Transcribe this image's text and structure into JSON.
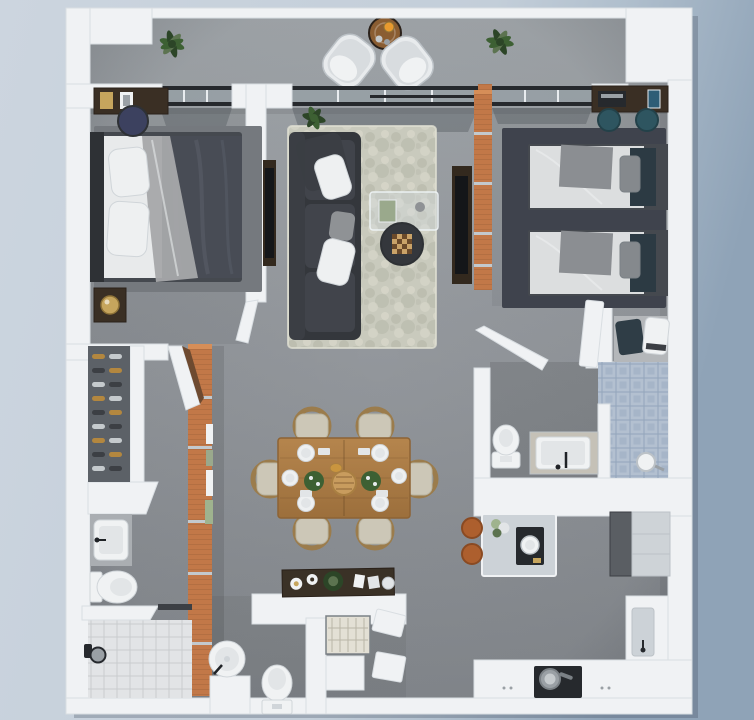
{
  "meta": {
    "scene": "3d-apartment-floor-plan-top-view",
    "canvas_width": 754,
    "canvas_height": 720
  },
  "palette": {
    "bg_left": "#ccd5df",
    "bg_mid": "#c3ced9",
    "bg_right": "#8fa3b7",
    "building_shadow": "rgba(60,72,88,0.28)",
    "wall": "#f0f2f4",
    "wall_stroke": "#d9dee2",
    "floor_light": "#a3a8ac",
    "floor": "#94989d",
    "floor_dark": "#85898e",
    "rug_living_base": "#c9cabd",
    "rug_living_blob": "#b2b4a5",
    "rug_living_light": "#dad9cc",
    "rug_bed1": "#75797e",
    "rug_bed2": "#3f434d",
    "sofa": "#34373c",
    "sofa_cushion": "#41444b",
    "sofa_edge": "#3b3e44",
    "pillow_white": "#eef0f1",
    "pillow_gray": "#8f9295",
    "mattress": "#dcdedf",
    "sheet": "#e8eaeb",
    "duvet": "#484c55",
    "duvet_fold": "#575b65",
    "drape": "#a6a8aa",
    "headboard": "#2e3135",
    "bed_frame": "#45494f",
    "throw_gray": "#8b8e92",
    "blanket_teal": "#2c3a43",
    "pillow_stripe": "#85898d",
    "wood_dark": "#3a2f24",
    "wood_dark_edge": "#2a211a",
    "wood_dining_light": "#b5854d",
    "wood_dining_deep": "#9c6f3c",
    "wood_dining_stroke": "#8d6334",
    "wood_balcony": "#8a5d32",
    "brick": "#c27848",
    "brick_cap": "#d68e58",
    "brick_band": "#c3c9cd",
    "teal_stool": "#2e5560",
    "teal_stool_dark": "#234149",
    "navy_stool": "#3c415f",
    "brass": "#c6a55d",
    "brass_dark": "#8f7338",
    "glass_rail": "#26292d",
    "glass_pane": "rgba(150,160,168,0.55)",
    "glass_mullion": "#e8ecef",
    "glass_projection": "rgba(60,66,74,0.30)",
    "tile_light_a": "#e2e4e6",
    "tile_light_b": "#c9ccce",
    "tile_blue_a": "#b3c0d0",
    "tile_blue_b": "#93a5bb",
    "counter_gray": "#aaaeb2",
    "counter_beige": "#c5c1b7",
    "fixture_white": "#f0f2f3",
    "fixture_inner": "#e2e5e7",
    "fixture_stroke": "#d0d5d9",
    "black_fixture": "#1f2226",
    "island": "#ccd2d7",
    "appliance_dark": "#26292d",
    "fridge": "#5a5e63",
    "cabinet": "#ced3d7",
    "cabinet_stroke": "#bcc2c7",
    "steel": "#9aa0a5",
    "steel_dark": "#7b8186",
    "orange_stool": "#ad5f2e",
    "orange_stool_dark": "#8a4a22",
    "orange_juice": "#e89a2f",
    "plant": "#3d6033",
    "plant_dark": "#2c4527",
    "plant_light": "#5c7350",
    "plant_pale": "#9fb38e",
    "chair_shell": "#e8ebed",
    "chair_inner": "#d8dcdf",
    "dining_cushion": "#ccc7b7",
    "dining_cushion_stroke": "#b9b4a2",
    "chair_wood": "#9b7c4c",
    "tv_screen": "#141619",
    "console_wood": "#33291e",
    "decor_tray": "#3a3126",
    "washer_top": "#e3e0d5",
    "washer_line": "#b9b6a8",
    "book_blue": "#2e5d76",
    "book_green": "#9aa98c",
    "bottle_amber": "#b3873f",
    "bottle_dark": "#3c3f44",
    "bottle_silver": "#c5cacd",
    "rack_panel": "#5c6167",
    "alcove_mat": "#b4b7ba",
    "towel_dark": "#2f3d46",
    "trivet": "#c89c5e",
    "trivet_stroke": "#a97f42",
    "bread": "#c9953f",
    "chess_light": "#caa368",
    "chess_dark": "#6b4a2a",
    "door_face_brown": "#6e4a30"
  },
  "rooms": [
    {
      "id": "balcony",
      "items": [
        "lounge-chair",
        "lounge-chair",
        "round-wood-table",
        "orange-juice-glass",
        "potted-plant",
        "potted-plant",
        "sliding-glass-doors"
      ]
    },
    {
      "id": "bedroom-1",
      "items": [
        "double-bed",
        "white-pillows",
        "gray-drape",
        "dresser",
        "navy-stool",
        "nightstand",
        "brass-lamp",
        "area-rug",
        "tv-panel",
        "door"
      ]
    },
    {
      "id": "living-room",
      "items": [
        "charcoal-sofa",
        "shag-rug",
        "glass-coffee-table",
        "round-side-table",
        "chess-set",
        "potted-plant"
      ]
    },
    {
      "id": "bedroom-2",
      "items": [
        "single-bed",
        "single-bed",
        "desk",
        "laptop",
        "book",
        "teal-stool",
        "teal-stool",
        "area-rug",
        "tv-console",
        "wardrobe",
        "towel-alcove"
      ]
    },
    {
      "id": "bathroom-1",
      "items": [
        "toilet",
        "vanity-counter",
        "sink",
        "walk-in-shower",
        "blue-tile-floor",
        "shower-head",
        "door"
      ]
    },
    {
      "id": "bathroom-2",
      "items": [
        "sink-counter",
        "toilet",
        "bench",
        "tile-floor",
        "shower-head"
      ]
    },
    {
      "id": "wine-closet",
      "items": [
        "wine-rack",
        "wine-bottles",
        "counter"
      ]
    },
    {
      "id": "dining-area",
      "items": [
        "dining-table",
        "dining-chair",
        "dining-chair",
        "dining-chair",
        "dining-chair",
        "dining-chair",
        "dining-chair",
        "place-settings",
        "centerpiece-plants",
        "woven-trivet"
      ]
    },
    {
      "id": "laundry-room",
      "items": [
        "sideboard",
        "decor-tray",
        "washer",
        "round-basin",
        "toilet",
        "brick-partition"
      ]
    },
    {
      "id": "kitchen",
      "items": [
        "island",
        "coffee-machine",
        "flowers",
        "bar-stool",
        "bar-stool",
        "fridge",
        "tall-cabinets",
        "sink-counter",
        "cooktop",
        "pot"
      ]
    }
  ]
}
